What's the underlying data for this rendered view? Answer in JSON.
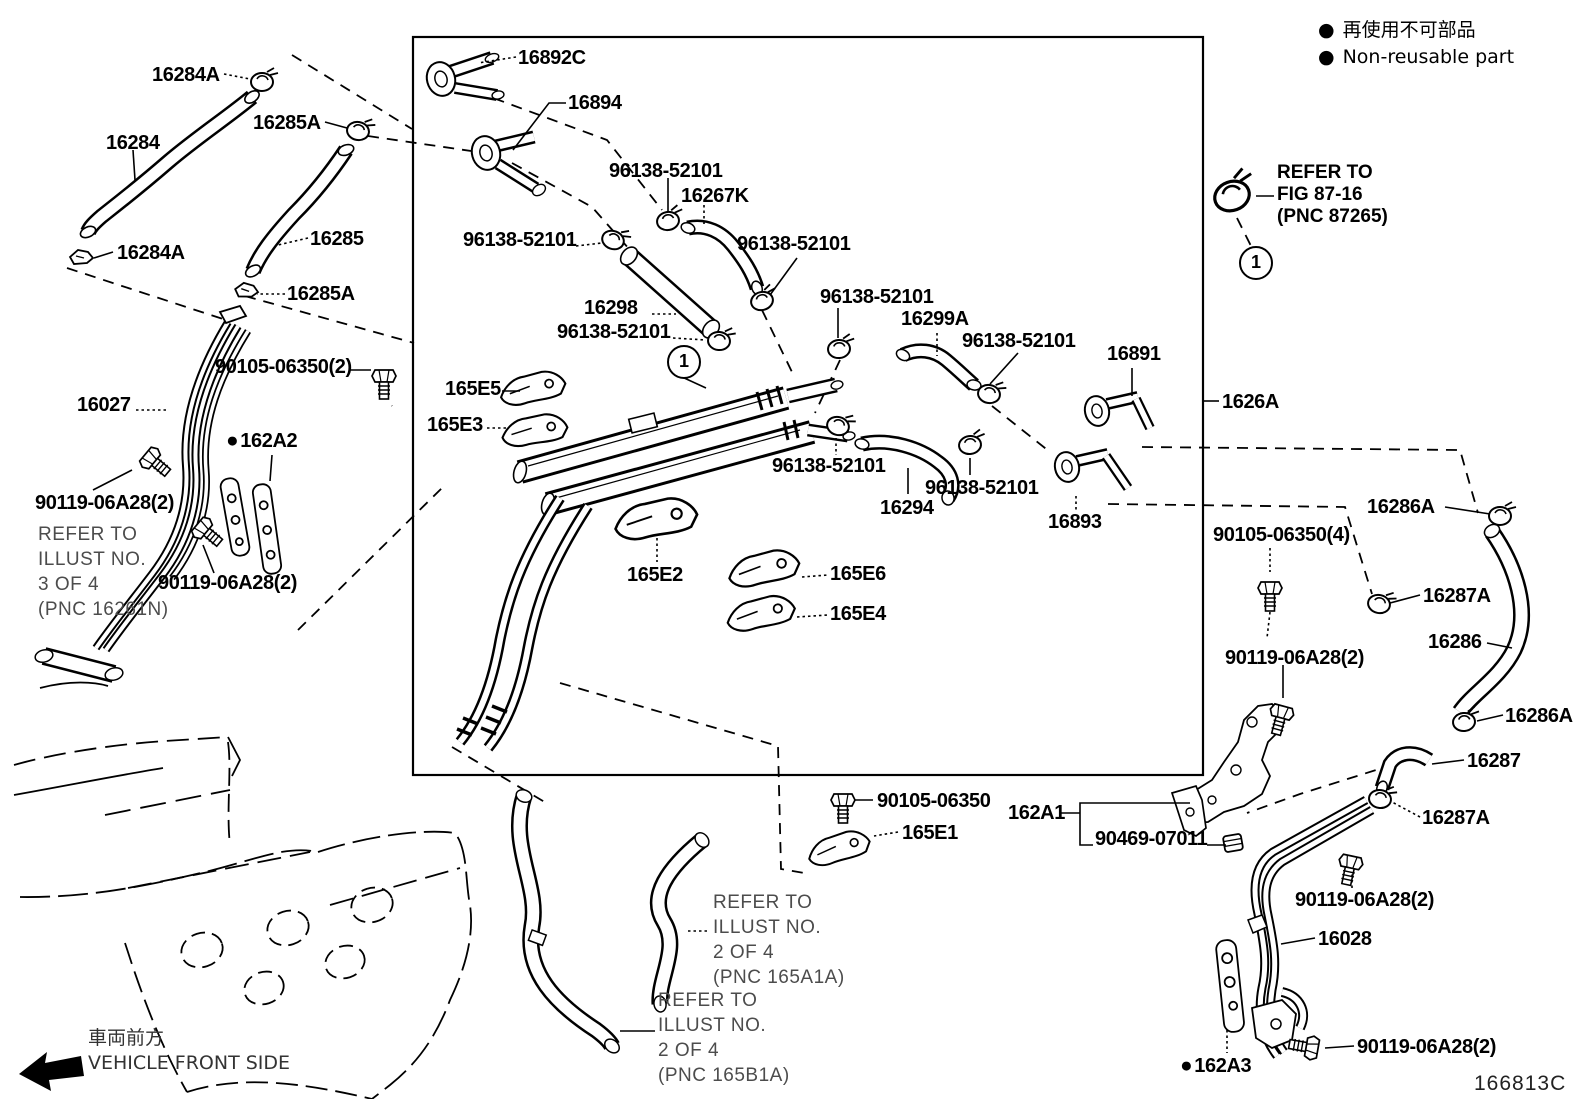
{
  "page": {
    "background": "#ffffff",
    "line_color": "#000000",
    "note_color": "#4c4c4c"
  },
  "legend": {
    "items": [
      {
        "bullet": "●",
        "text": "再使用不可部品"
      },
      {
        "bullet": "●",
        "text": "Non-reusable part"
      }
    ]
  },
  "front_side": {
    "jp": "車両前方",
    "en": "VEHICLE FRONT SIDE"
  },
  "diagram_number": "166813C",
  "circled_markers": [
    {
      "n": "1",
      "x": 682,
      "y": 360
    },
    {
      "n": "1",
      "x": 1254,
      "y": 261
    }
  ],
  "notes": [
    {
      "x": 38,
      "y": 522,
      "dark": false,
      "lines": [
        "REFER TO",
        "ILLUST NO.",
        "3 OF 4",
        "(PNC 16261N)"
      ]
    },
    {
      "x": 1277,
      "y": 162,
      "dark": true,
      "lines": [
        "REFER TO",
        "FIG 87-16",
        "(PNC 87265)"
      ]
    },
    {
      "x": 713,
      "y": 890,
      "dark": false,
      "lines": [
        "REFER TO",
        "ILLUST NO.",
        "2 OF 4",
        "(PNC 165A1A)"
      ]
    },
    {
      "x": 658,
      "y": 988,
      "dark": false,
      "lines": [
        "REFER TO",
        "ILLUST NO.",
        "2 OF 4",
        "(PNC 165B1A)"
      ]
    }
  ],
  "callouts": [
    {
      "text": "16284A",
      "x": 152,
      "y": 64
    },
    {
      "text": "16284",
      "x": 106,
      "y": 132
    },
    {
      "text": "16285A",
      "x": 253,
      "y": 112
    },
    {
      "text": "16285",
      "x": 310,
      "y": 228
    },
    {
      "text": "16284A",
      "x": 117,
      "y": 242
    },
    {
      "text": "16285A",
      "x": 287,
      "y": 283
    },
    {
      "text": "16892C",
      "x": 518,
      "y": 47
    },
    {
      "text": "16894",
      "x": 568,
      "y": 92
    },
    {
      "text": "96138-52101",
      "x": 609,
      "y": 160
    },
    {
      "text": "16267K",
      "x": 681,
      "y": 185
    },
    {
      "text": "96138-52101",
      "x": 463,
      "y": 229
    },
    {
      "text": "96138-52101",
      "x": 737,
      "y": 233
    },
    {
      "text": "16298",
      "x": 584,
      "y": 297
    },
    {
      "text": "96138-52101",
      "x": 557,
      "y": 321
    },
    {
      "text": "96138-52101",
      "x": 820,
      "y": 286
    },
    {
      "text": "16299A",
      "x": 901,
      "y": 308
    },
    {
      "text": "96138-52101",
      "x": 962,
      "y": 330
    },
    {
      "text": "16891",
      "x": 1107,
      "y": 343
    },
    {
      "text": "1626A",
      "x": 1222,
      "y": 391
    },
    {
      "text": "90105-06350(2)",
      "x": 215,
      "y": 356
    },
    {
      "text": "16027",
      "x": 77,
      "y": 394
    },
    {
      "bullet": "●",
      "text": "162A2",
      "x": 226,
      "y": 430
    },
    {
      "text": "90119-06A28(2)",
      "x": 35,
      "y": 492
    },
    {
      "text": "90119-06A28(2)",
      "x": 158,
      "y": 572
    },
    {
      "text": "165E5",
      "x": 445,
      "y": 378
    },
    {
      "text": "165E3",
      "x": 427,
      "y": 414
    },
    {
      "text": "96138-52101",
      "x": 772,
      "y": 455
    },
    {
      "text": "16294",
      "x": 880,
      "y": 497
    },
    {
      "text": "96138-52101",
      "x": 925,
      "y": 477
    },
    {
      "text": "16893",
      "x": 1048,
      "y": 511
    },
    {
      "text": "165E2",
      "x": 627,
      "y": 564
    },
    {
      "text": "165E6",
      "x": 830,
      "y": 563
    },
    {
      "text": "165E4",
      "x": 830,
      "y": 603
    },
    {
      "text": "16286A",
      "x": 1367,
      "y": 496
    },
    {
      "text": "90105-06350(4)",
      "x": 1213,
      "y": 524
    },
    {
      "text": "16287A",
      "x": 1423,
      "y": 585
    },
    {
      "text": "16286",
      "x": 1428,
      "y": 631
    },
    {
      "text": "16286A",
      "x": 1505,
      "y": 705
    },
    {
      "text": "16287",
      "x": 1467,
      "y": 750
    },
    {
      "text": "16287A",
      "x": 1422,
      "y": 807
    },
    {
      "text": "90119-06A28(2)",
      "x": 1225,
      "y": 647
    },
    {
      "text": "162A1",
      "x": 1008,
      "y": 802
    },
    {
      "text": "90469-07011",
      "x": 1095,
      "y": 828
    },
    {
      "text": "90105-06350",
      "x": 877,
      "y": 790
    },
    {
      "text": "165E1",
      "x": 902,
      "y": 822
    },
    {
      "text": "90119-06A28(2)",
      "x": 1295,
      "y": 889
    },
    {
      "text": "16028",
      "x": 1318,
      "y": 928
    },
    {
      "bullet": "●",
      "text": "162A3",
      "x": 1180,
      "y": 1055
    },
    {
      "text": "90119-06A28(2)",
      "x": 1357,
      "y": 1036
    }
  ]
}
